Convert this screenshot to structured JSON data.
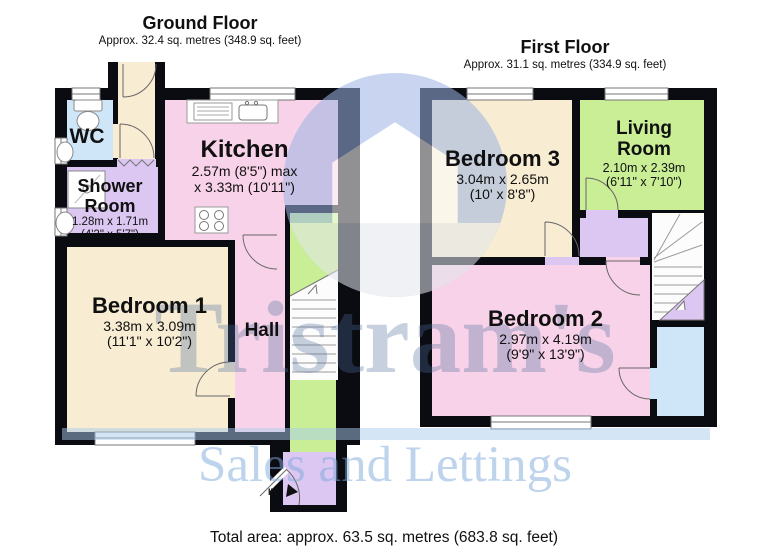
{
  "watermark": {
    "brand": "Tristram's",
    "tagline": "Sales and Lettings"
  },
  "footer": {
    "total_area": "Total area: approx. 63.5 sq. metres (683.8 sq. feet)"
  },
  "ground_floor": {
    "title": "Ground Floor",
    "subtitle": "Approx. 32.4 sq. metres (348.9 sq. feet)",
    "entrance_label": "IN",
    "rooms": {
      "wc": {
        "name": "WC"
      },
      "shower": {
        "name": "Shower Room",
        "dims_m": "1.28m x 1.71m",
        "dims_ft": "(4'2\" x 5'7\")"
      },
      "kitchen": {
        "name": "Kitchen",
        "dims_m": "2.57m (8'5\") max",
        "dims_ft": "x 3.33m (10'11\")"
      },
      "bedroom1": {
        "name": "Bedroom 1",
        "dims_m": "3.38m x 3.09m",
        "dims_ft": "(11'1\" x 10'2\")"
      },
      "hall": {
        "name": "Hall"
      }
    }
  },
  "first_floor": {
    "title": "First Floor",
    "subtitle": "Approx. 31.1 sq. metres (334.9 sq. feet)",
    "rooms": {
      "bedroom3": {
        "name": "Bedroom 3",
        "dims_m": "3.04m x 2.65m",
        "dims_ft": "(10' x 8'8\")"
      },
      "living": {
        "name": "Living Room",
        "dims_m": "2.10m x 2.39m",
        "dims_ft": "(6'11\" x 7'10\")"
      },
      "bedroom2": {
        "name": "Bedroom 2",
        "dims_m": "2.97m x 4.19m",
        "dims_ft": "(9'9\" x 13'9\")"
      }
    }
  },
  "colors": {
    "wall": "#0b0b12",
    "cream_room": "#f8ecd2",
    "pink_room": "#f8d2e8",
    "purple_room": "#dcc7f2",
    "blue_room": "#cfe6f8",
    "green_room": "#c9ee96",
    "watermark_blue": "#50709f",
    "emblem_blue": "#9db4e4"
  }
}
